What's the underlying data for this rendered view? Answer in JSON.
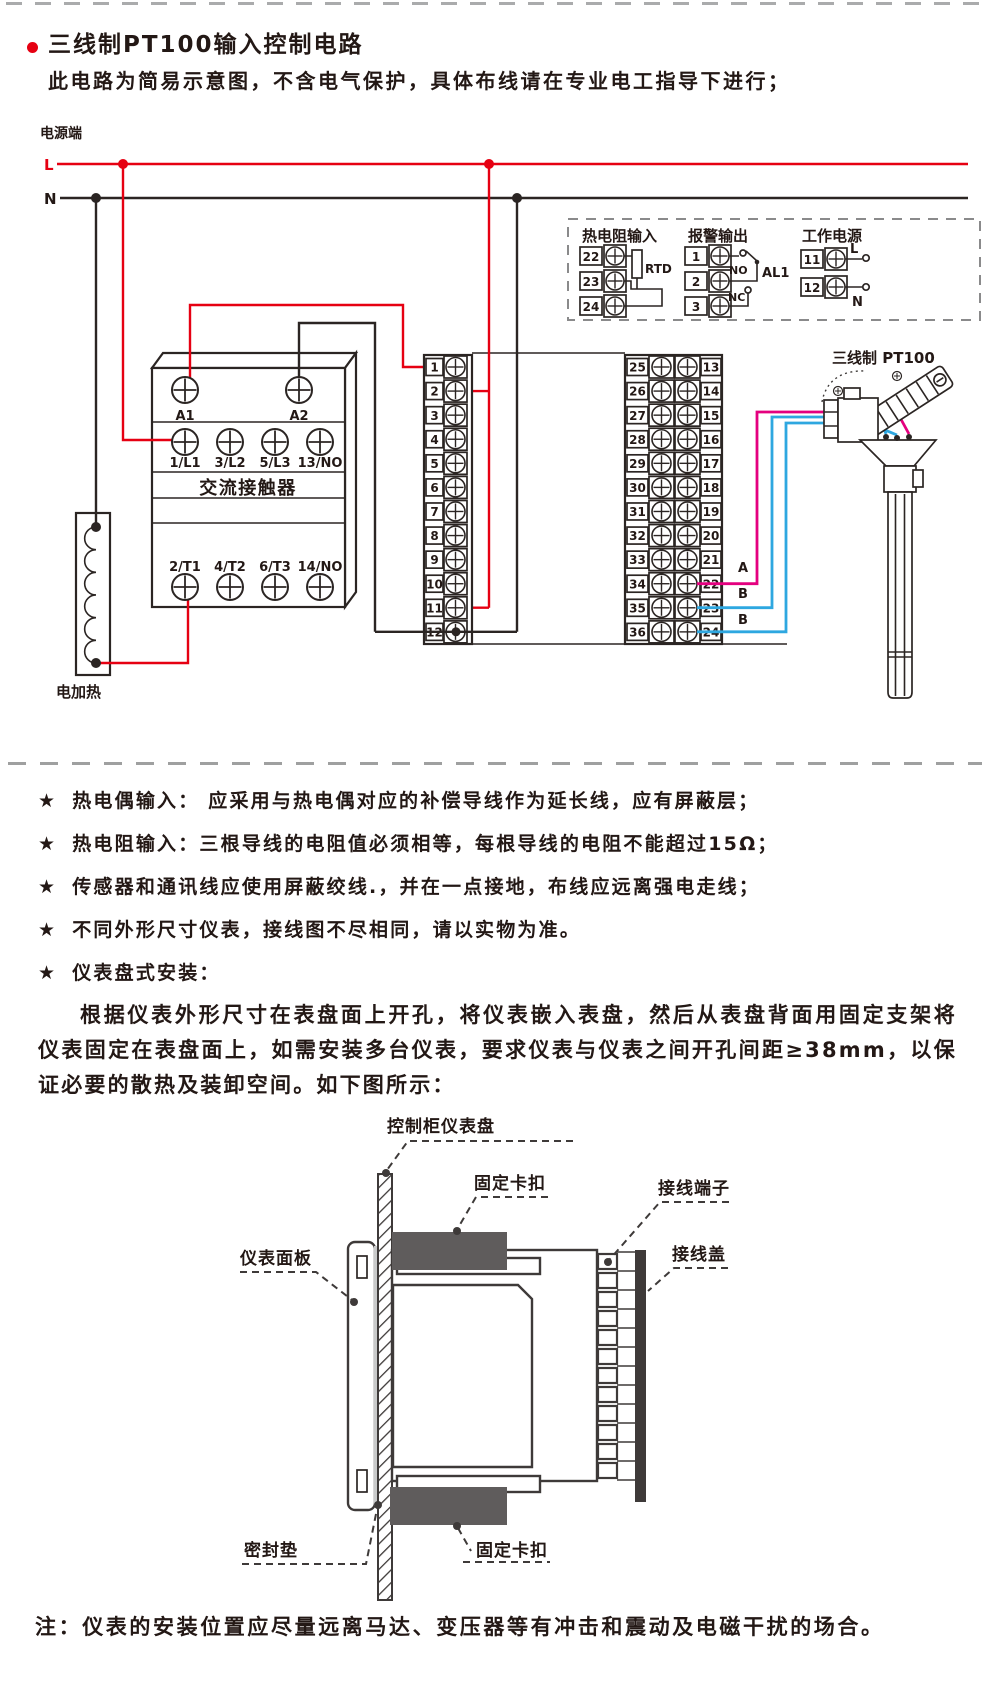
{
  "header": {
    "title": "三线制PT100输入控制电路",
    "subtitle": "此电路为简易示意图，不含电气保护，具体布线请在专业电工指导下进行；"
  },
  "circuit": {
    "power_label": "电源端",
    "l": "L",
    "n": "N",
    "colors": {
      "red": "#e60012",
      "magenta": "#e4007f",
      "blue": "#2ea7e0",
      "line": "#2b2523"
    },
    "legend": {
      "rtd": {
        "title": "热电阻输入",
        "terminals": [
          "22",
          "23",
          "24"
        ],
        "component": "RTD"
      },
      "alarm": {
        "title": "报警输出",
        "terminals": [
          "1",
          "2",
          "3"
        ],
        "no_label": "NO",
        "nc_label": "NC",
        "name": "AL1"
      },
      "supply": {
        "title": "工作电源",
        "terminals": [
          "11",
          "12"
        ],
        "l": "L",
        "n": "N"
      }
    },
    "contactor": {
      "name": "交流接触器",
      "coil": [
        "A1",
        "A2"
      ],
      "top_row": [
        "1/L1",
        "3/L2",
        "5/L3",
        "13/NO"
      ],
      "bottom_row": [
        "2/T1",
        "4/T2",
        "6/T3",
        "14/NO"
      ]
    },
    "heater_label": "电加热",
    "left_terminals": [
      "1",
      "2",
      "3",
      "4",
      "5",
      "6",
      "7",
      "8",
      "9",
      "10",
      "11",
      "12"
    ],
    "right_terminals_left": [
      "25",
      "26",
      "27",
      "28",
      "29",
      "30",
      "31",
      "32",
      "33",
      "34",
      "35",
      "36"
    ],
    "right_terminals_right": [
      "13",
      "14",
      "15",
      "16",
      "17",
      "18",
      "19",
      "20",
      "21",
      "22",
      "23",
      "24"
    ],
    "sensor": {
      "label": "三线制  PT100",
      "wire_a": "A",
      "wire_b1": "B",
      "wire_b2": "B"
    }
  },
  "notes": {
    "star": "★",
    "bullets": [
      "热电偶输入： 应采用与热电偶对应的补偿导线作为延长线，应有屏蔽层；",
      "热电阻输入：三根导线的电阻值必须相等，每根导线的电阻不能超过15Ω；",
      "传感器和通讯线应使用屏蔽绞线.，并在一点接地，布线应远离强电走线；",
      "不同外形尺寸仪表，接线图不尽相同，请以实物为准。",
      "仪表盘式安装："
    ]
  },
  "install": {
    "paragraph": "根据仪表外形尺寸在表盘面上开孔，将仪表嵌入表盘，然后从表盘背面用固定支架将仪表固定在表盘面上，如需安装多台仪表，要求仪表与仪表之间开孔间距≥38mm，以保证必要的散热及装卸空间。如下图所示："
  },
  "mounting": {
    "labels": {
      "panel": "控制柜仪表盘",
      "clip_top": "固定卡扣",
      "terminal": "接线端子",
      "cover": "接线盖",
      "bezel": "仪表面板",
      "gasket": "密封垫",
      "clip_bottom": "固定卡扣"
    }
  },
  "footer": {
    "note": "注：仪表的安装位置应尽量远离马达、变压器等有冲击和震动及电磁干扰的场合。"
  }
}
